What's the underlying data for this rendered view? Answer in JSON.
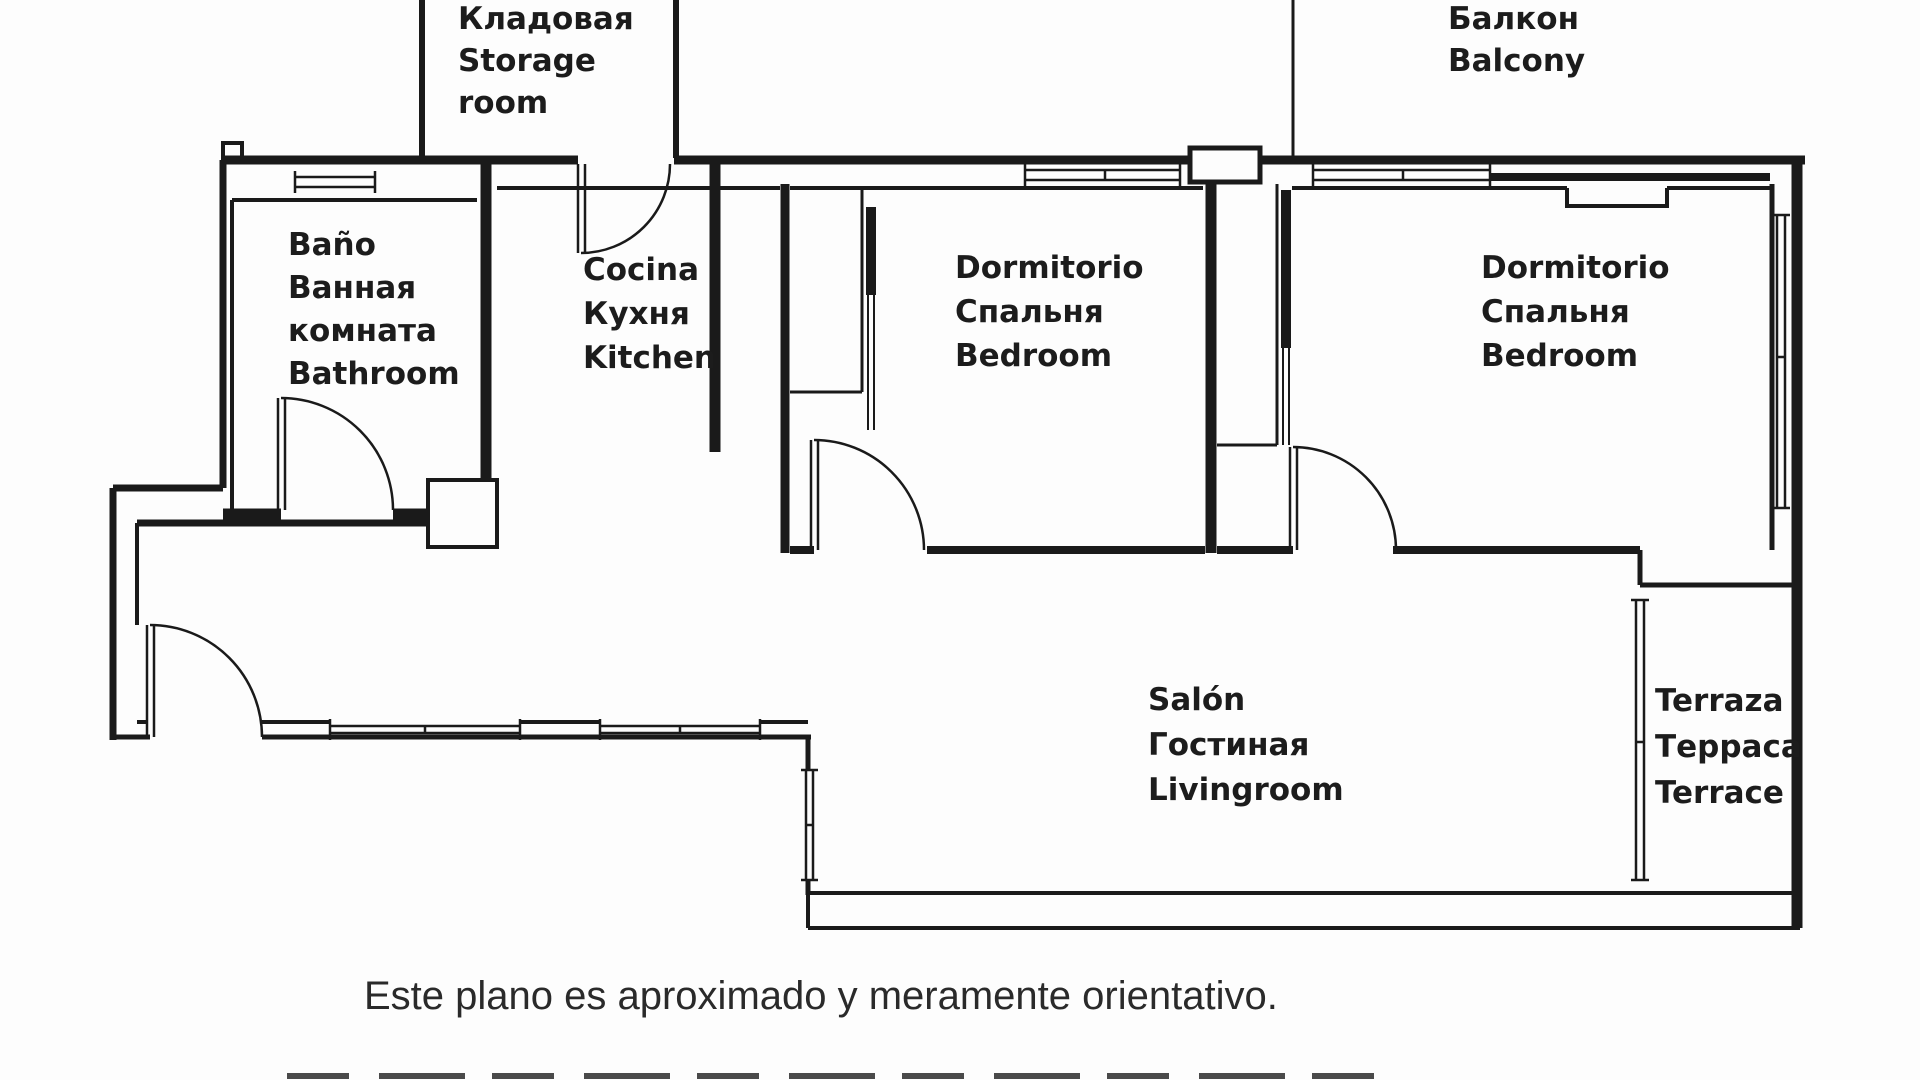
{
  "colors": {
    "background": "#fdfdfd",
    "lines": "#1a1a1a",
    "text": "#1c1c1c"
  },
  "rooms": {
    "storage": {
      "label": "Кладовая\nStorage\nroom"
    },
    "balcony": {
      "label": "Балкон\nBalcony"
    },
    "bathroom": {
      "label": "Baño\nВанная\nкомната\nBathroom"
    },
    "kitchen": {
      "label": "Cocina\nКухня\nKitchen"
    },
    "bedroom1": {
      "label": "Dormitorio\nСпальня\nBedroom"
    },
    "bedroom2": {
      "label": "Dormitorio\nСпальня\nBedroom"
    },
    "livingroom": {
      "label": "Salón\nГостиная\nLivingroom"
    },
    "terrace": {
      "label": "Terraza\nТерраса\nTerrace"
    }
  },
  "caption": {
    "text": "Este plano es aproximado y meramente orientativo."
  }
}
